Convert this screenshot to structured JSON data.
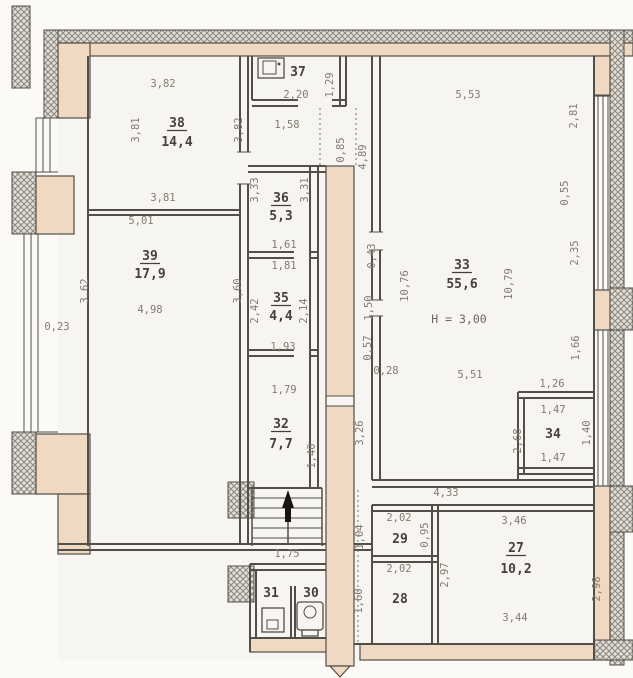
{
  "drawing": {
    "type": "floor-plan",
    "rooms": [
      {
        "number": "27",
        "area": "10,2"
      },
      {
        "number": "28"
      },
      {
        "number": "29"
      },
      {
        "number": "30"
      },
      {
        "number": "31"
      },
      {
        "number": "32",
        "area": "7,7"
      },
      {
        "number": "33",
        "area": "55,6",
        "note": "Н = 3,00"
      },
      {
        "number": "34"
      },
      {
        "number": "35",
        "area": "4,4"
      },
      {
        "number": "36",
        "area": "5,3"
      },
      {
        "number": "37"
      },
      {
        "number": "38",
        "area": "14,4"
      },
      {
        "number": "39",
        "area": "17,9"
      }
    ],
    "colors": {
      "wall_core": "#f0d9c2",
      "line": "#524e48",
      "dim_text": "#847b6f",
      "room_text": "#45403a"
    },
    "labels": [
      {
        "t": "3,82",
        "x": 163,
        "y": 87
      },
      {
        "t": "37",
        "x": 298,
        "y": 76,
        "s": "numplain"
      },
      {
        "t": "2,20",
        "x": 296,
        "y": 98
      },
      {
        "t": "1,29",
        "x": 333,
        "y": 85,
        "r": -90
      },
      {
        "t": "5,53",
        "x": 468,
        "y": 98
      },
      {
        "t": "1,58",
        "x": 287,
        "y": 128
      },
      {
        "t": "0,85",
        "x": 344,
        "y": 150,
        "r": -90
      },
      {
        "t": "4,89",
        "x": 366,
        "y": 157,
        "r": -90
      },
      {
        "t": "3,81",
        "x": 139,
        "y": 130,
        "r": -90
      },
      {
        "t": "3,82",
        "x": 242,
        "y": 130,
        "r": -90
      },
      {
        "t": "38",
        "x": 177,
        "y": 127,
        "s": "num"
      },
      {
        "t": "14,4",
        "x": 177,
        "y": 146,
        "s": "area"
      },
      {
        "t": "2,81",
        "x": 577,
        "y": 116,
        "r": -90
      },
      {
        "t": "3,81",
        "x": 163,
        "y": 201
      },
      {
        "t": "5,01",
        "x": 141,
        "y": 224
      },
      {
        "t": "3,33",
        "x": 258,
        "y": 190,
        "r": -90
      },
      {
        "t": "3,31",
        "x": 308,
        "y": 190,
        "r": -90
      },
      {
        "t": "36",
        "x": 281,
        "y": 202,
        "s": "num"
      },
      {
        "t": "5,3",
        "x": 281,
        "y": 220,
        "s": "area"
      },
      {
        "t": "0,55",
        "x": 568,
        "y": 193,
        "r": -90
      },
      {
        "t": "1,61",
        "x": 284,
        "y": 248
      },
      {
        "t": "1,81",
        "x": 284,
        "y": 269
      },
      {
        "t": "39",
        "x": 150,
        "y": 260,
        "s": "num"
      },
      {
        "t": "17,9",
        "x": 150,
        "y": 278,
        "s": "area"
      },
      {
        "t": "3,62",
        "x": 88,
        "y": 291,
        "r": -90
      },
      {
        "t": "3,60",
        "x": 241,
        "y": 291,
        "r": -90
      },
      {
        "t": "2,42",
        "x": 258,
        "y": 311,
        "r": -90
      },
      {
        "t": "2,14",
        "x": 307,
        "y": 311,
        "r": -90
      },
      {
        "t": "35",
        "x": 281,
        "y": 302,
        "s": "num"
      },
      {
        "t": "4,4",
        "x": 281,
        "y": 320,
        "s": "area"
      },
      {
        "t": "10,76",
        "x": 408,
        "y": 286,
        "r": -90
      },
      {
        "t": "10,79",
        "x": 512,
        "y": 284,
        "r": -90
      },
      {
        "t": "33",
        "x": 462,
        "y": 269,
        "s": "num"
      },
      {
        "t": "55,6",
        "x": 462,
        "y": 288,
        "s": "area"
      },
      {
        "t": "Н = 3,00",
        "x": 459,
        "y": 323,
        "s": "note"
      },
      {
        "t": "2,35",
        "x": 578,
        "y": 253,
        "r": -90
      },
      {
        "t": "0,43",
        "x": 375,
        "y": 256,
        "r": -90
      },
      {
        "t": "1,50",
        "x": 372,
        "y": 308,
        "r": -90
      },
      {
        "t": "4,98",
        "x": 150,
        "y": 313
      },
      {
        "t": "0,23",
        "x": 57,
        "y": 330
      },
      {
        "t": "1,93",
        "x": 283,
        "y": 350
      },
      {
        "t": "0,57",
        "x": 371,
        "y": 348,
        "r": -90
      },
      {
        "t": "0,28",
        "x": 386,
        "y": 374
      },
      {
        "t": "1,79",
        "x": 284,
        "y": 393
      },
      {
        "t": "5,51",
        "x": 470,
        "y": 378
      },
      {
        "t": "1,66",
        "x": 579,
        "y": 348,
        "r": -90
      },
      {
        "t": "1,26",
        "x": 552,
        "y": 387
      },
      {
        "t": "32",
        "x": 281,
        "y": 428,
        "s": "num"
      },
      {
        "t": "7,7",
        "x": 281,
        "y": 448,
        "s": "area"
      },
      {
        "t": "3,26",
        "x": 363,
        "y": 433,
        "r": -90
      },
      {
        "t": "1,40",
        "x": 315,
        "y": 456,
        "r": -90
      },
      {
        "t": "1,47",
        "x": 553,
        "y": 413
      },
      {
        "t": "34",
        "x": 553,
        "y": 438,
        "s": "numplain"
      },
      {
        "t": "1,47",
        "x": 553,
        "y": 461
      },
      {
        "t": "2,68",
        "x": 521,
        "y": 441,
        "r": -90
      },
      {
        "t": "1,40",
        "x": 590,
        "y": 433,
        "r": -90
      },
      {
        "t": "4,33",
        "x": 446,
        "y": 496
      },
      {
        "t": "2,02",
        "x": 399,
        "y": 521
      },
      {
        "t": "29",
        "x": 400,
        "y": 543,
        "s": "numplain"
      },
      {
        "t": "1,04",
        "x": 363,
        "y": 537,
        "r": -90
      },
      {
        "t": "0,95",
        "x": 428,
        "y": 535,
        "r": -90
      },
      {
        "t": "3,46",
        "x": 514,
        "y": 524
      },
      {
        "t": "27",
        "x": 516,
        "y": 552,
        "s": "num"
      },
      {
        "t": "10,2",
        "x": 516,
        "y": 573,
        "s": "area"
      },
      {
        "t": "2,97",
        "x": 448,
        "y": 575,
        "r": -90
      },
      {
        "t": "2,98",
        "x": 600,
        "y": 589,
        "r": -90
      },
      {
        "t": "1,75",
        "x": 287,
        "y": 557
      },
      {
        "t": "2,02",
        "x": 399,
        "y": 572
      },
      {
        "t": "28",
        "x": 400,
        "y": 603,
        "s": "numplain"
      },
      {
        "t": "1,60",
        "x": 362,
        "y": 601,
        "r": -90
      },
      {
        "t": "31",
        "x": 271,
        "y": 597,
        "s": "numplain"
      },
      {
        "t": "30",
        "x": 311,
        "y": 597,
        "s": "numplain"
      },
      {
        "t": "3,44",
        "x": 515,
        "y": 621
      }
    ]
  }
}
